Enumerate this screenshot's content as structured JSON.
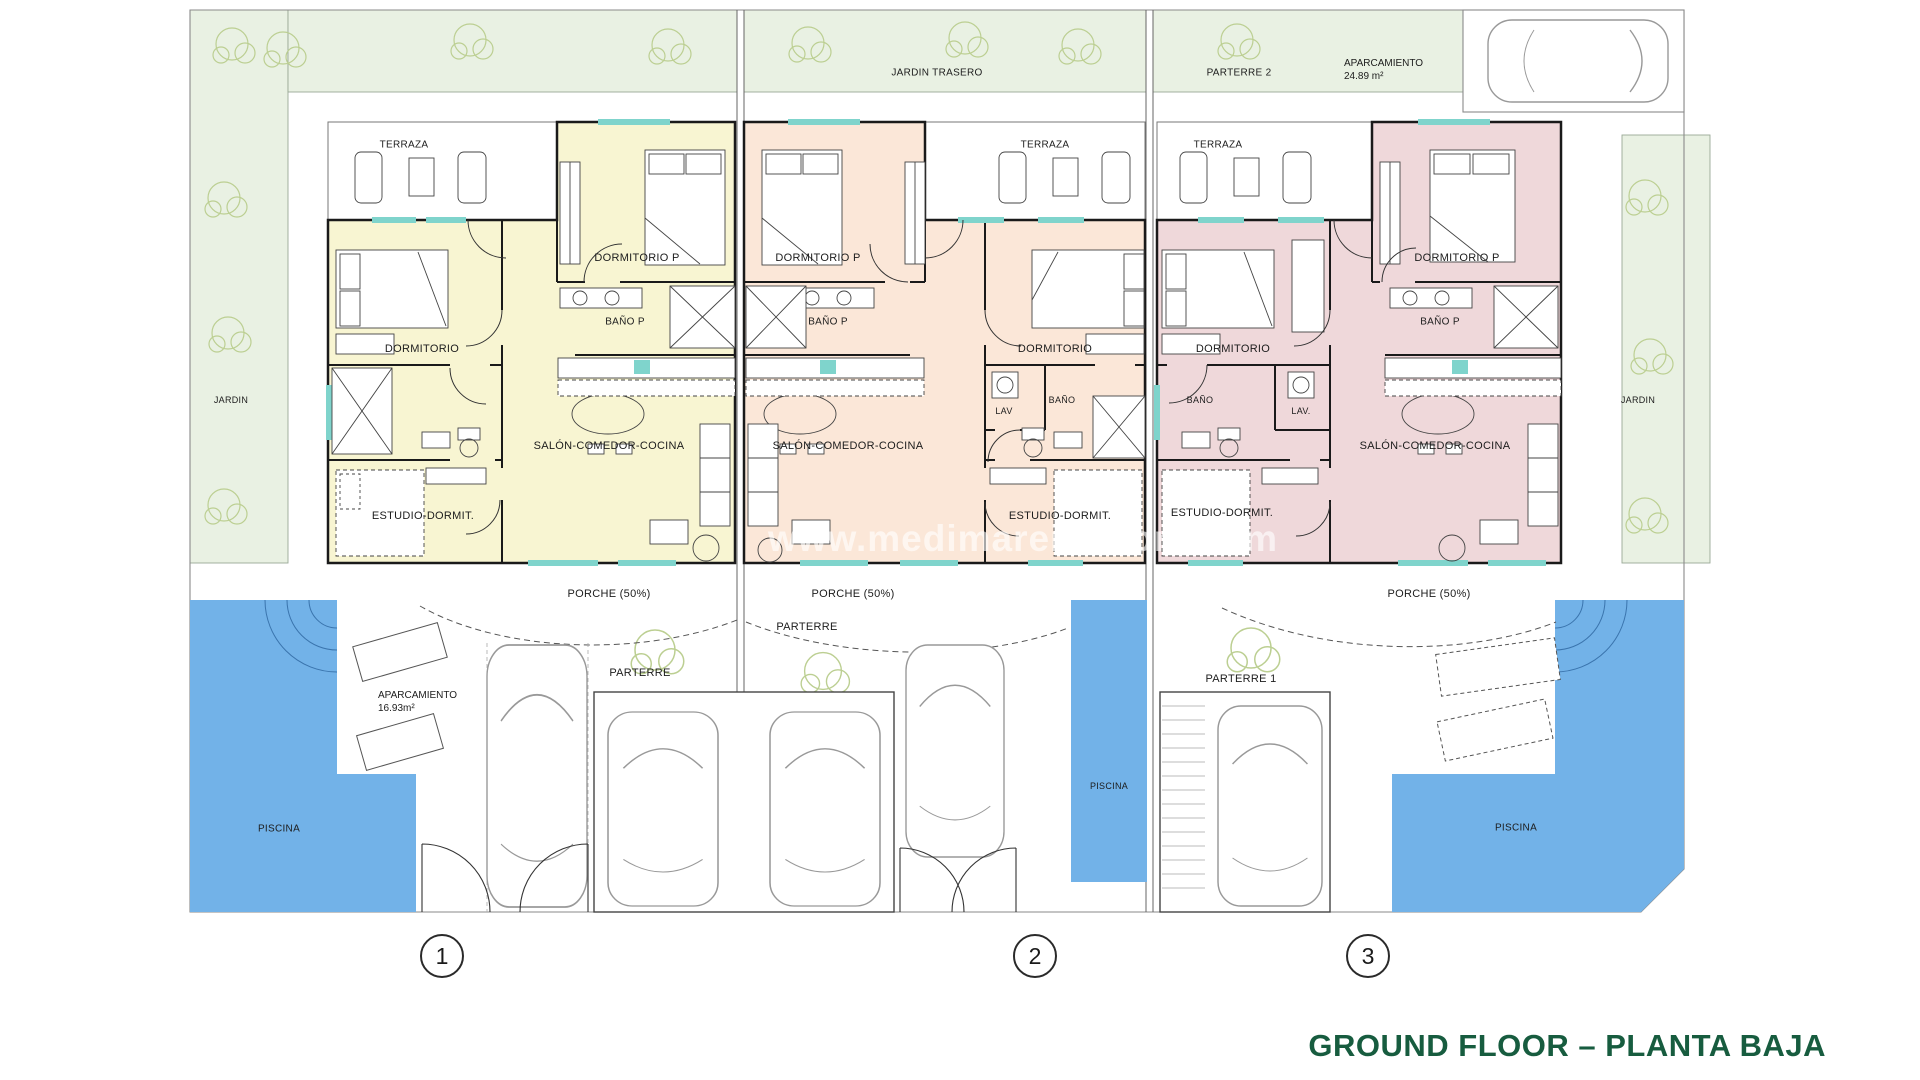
{
  "title": "GROUND FLOOR – PLANTA BAJA",
  "watermark": "www.medimareiendom.com",
  "colors": {
    "unit1_fill": "#f8f5d2",
    "unit2_fill": "#fbe7d8",
    "unit3_fill": "#efd8da",
    "pool_blue": "#72b2e8",
    "garden_green": "#e9f1e3",
    "title_green": "#175c3f",
    "window_cyan": "#7fd4cc"
  },
  "site": {
    "jardin_left": "JARDIN",
    "jardin_trasero": "JARDIN TRASERO",
    "parterre_2": "PARTERRE 2",
    "aparcamiento_top_label": "APARCAMIENTO",
    "aparcamiento_top_area": "24.89 m²",
    "jardin_right": "JARDIN"
  },
  "units": [
    {
      "number": "1",
      "rooms": {
        "terraza": "TERRAZA",
        "dormitorio_p": "DORMITORIO P",
        "bano_p": "BAÑO P",
        "dormitorio": "DORMITORIO",
        "salon": "SALÓN-COMEDOR-COCINA",
        "estudio": "ESTUDIO-DORMIT."
      },
      "outdoor": {
        "porche": "PORCHE (50%)",
        "parterre": "PARTERRE",
        "aparcamiento_label": "APARCAMIENTO",
        "aparcamiento_area": "16.93m²",
        "piscina": "PISCINA"
      }
    },
    {
      "number": "2",
      "rooms": {
        "terraza": "TERRAZA",
        "dormitorio_p": "DORMITORIO P",
        "bano_p": "BAÑO P",
        "dormitorio": "DORMITORIO",
        "lav": "LAV",
        "bano": "BAÑO",
        "salon": "SALÓN-COMEDOR-COCINA",
        "estudio": "ESTUDIO-DORMIT."
      },
      "outdoor": {
        "porche": "PORCHE (50%)",
        "parterre": "PARTERRE",
        "piscina": "PISCINA"
      }
    },
    {
      "number": "3",
      "rooms": {
        "terraza": "TERRAZA",
        "dormitorio_p": "DORMITORIO P",
        "bano_p": "BAÑO P",
        "dormitorio": "DORMITORIO",
        "bano": "BAÑO",
        "lav": "LAV.",
        "salon": "SALÓN-COMEDOR-COCINA",
        "estudio": "ESTUDIO-DORMIT."
      },
      "outdoor": {
        "porche": "PORCHE (50%)",
        "parterre": "PARTERRE 1",
        "piscina": "PISCINA"
      }
    }
  ]
}
